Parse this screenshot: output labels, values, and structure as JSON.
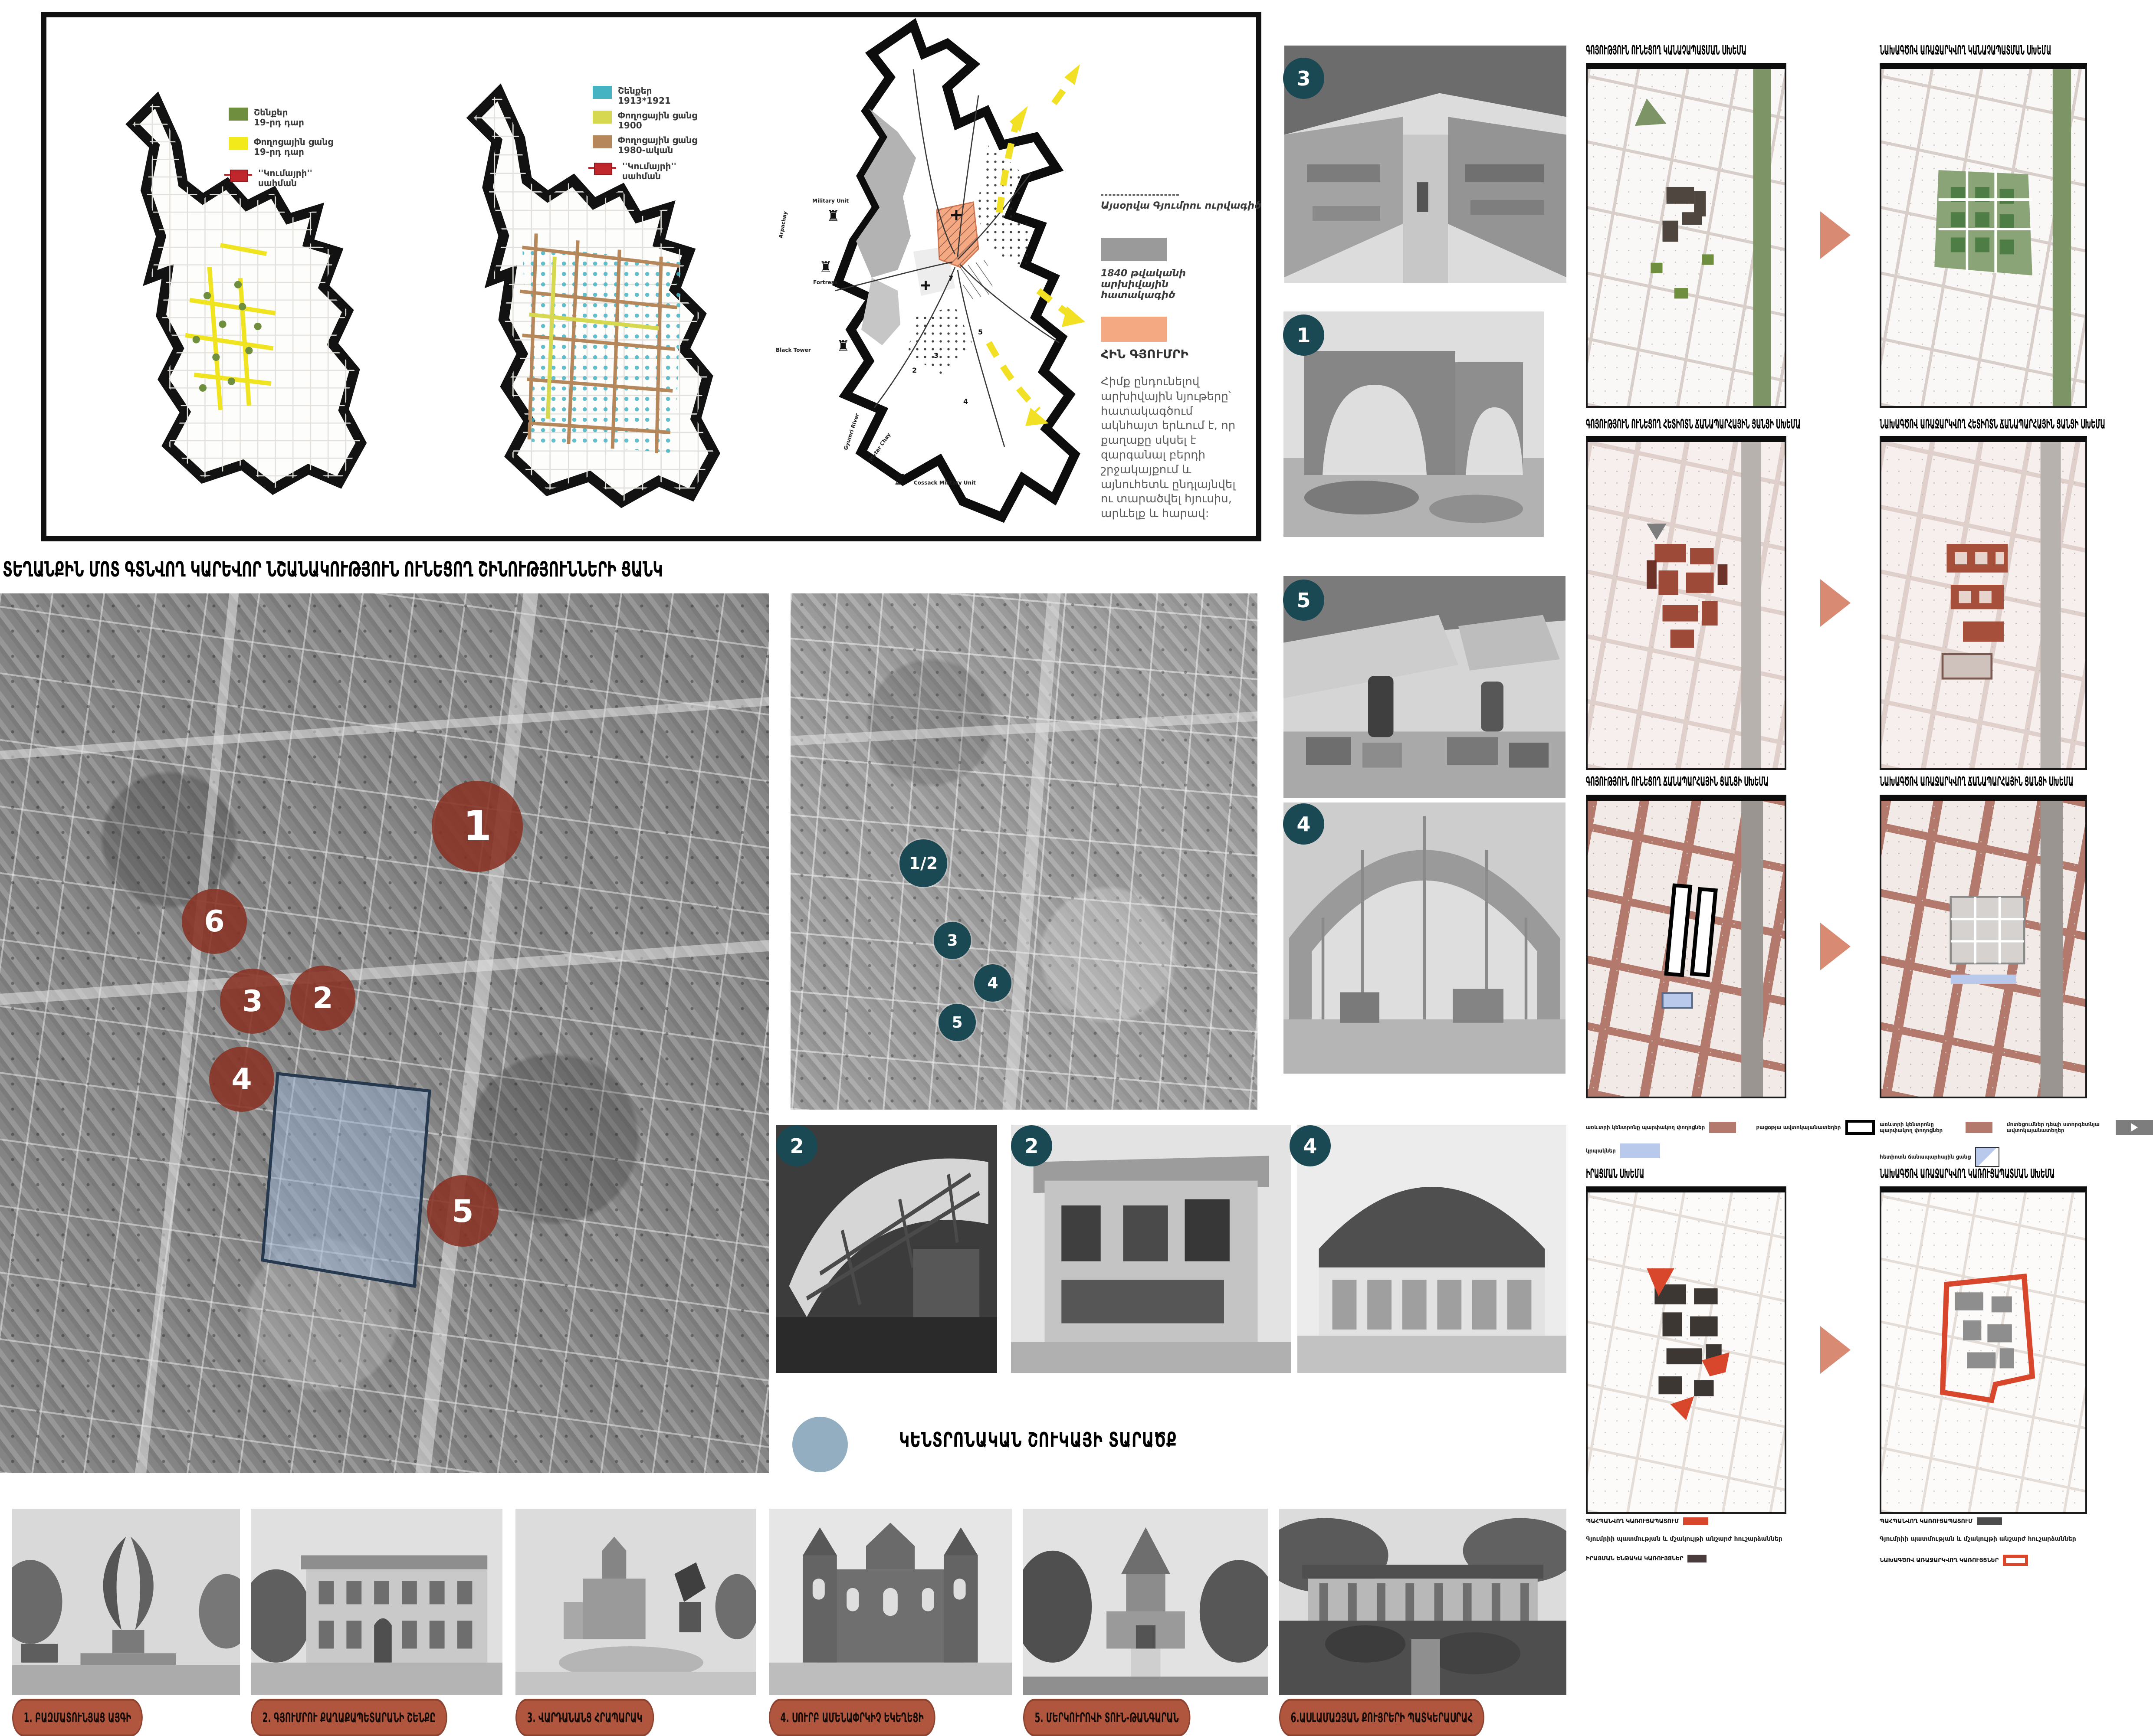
{
  "colors": {
    "accent_terracotta": "#8c392b",
    "accent_teal": "#1a4853",
    "accent_salmon": "#d98a72",
    "accent_red": "#d8472b",
    "legend_green": "#6f8f3f",
    "legend_yellow": "#f2ea1b",
    "legend_teal": "#45b3c2",
    "legend_yellowgreen": "#d6d94f",
    "legend_brown": "#b5875a",
    "legend_boundary_red": "#c0272d",
    "old_gyumri_orange": "#f5a983",
    "archive_gray": "#9a9a9a",
    "kiosk_blue": "#b9c9ec",
    "dark_structure": "#4a3c3c",
    "market_circle_blue": "#92aec0"
  },
  "panel": {
    "legend_a": [
      {
        "l1": "Շենքեր",
        "l2": "19-րդ դար"
      },
      {
        "l1": "Փողոցային ցանց",
        "l2": "19-րդ դար"
      },
      {
        "l1": "''Կումայրի''",
        "l2": "սահման"
      }
    ],
    "legend_b": [
      {
        "l1": "Շենքեր",
        "l2": "1913*1921"
      },
      {
        "l1": "Փողոցային ցանց",
        "l2": "1900"
      },
      {
        "l1": "Փողոցային ցանց",
        "l2": "1980-ական"
      },
      {
        "l1": "''Կումայրի''",
        "l2": "սահման"
      }
    ],
    "map3": {
      "military_unit": "Military Unit",
      "fortress": "Fortress",
      "arpachay": "Arpachay",
      "black_tower": "Black Tower",
      "gyumri_river": "Gyumri River",
      "mxtar_chay": "Mxtar Chay",
      "cossack": "Cossack Military Unit",
      "n2": "2",
      "n3": "3",
      "n4": "4",
      "n5": "5",
      "n7": "7",
      "plus": "+"
    },
    "notes": {
      "outline": "Այսօրվա Գյումրու ուրվագիծ",
      "archive": "1840 թվականի արխիվային հատակագիծ",
      "old_gyumri": "ՀԻՆ ԳՅՈՒՄՐԻ",
      "paragraph": "Հիմք ընդունելով արխիվային նյութերը՝ հատակագծում ակնհայտ երևում է, որ քաղաքը սկսել է զարգանալ բերդի շրջակայքում և այնուհետև ընդլայնվել ու տարածվել հյուսիս, արևելք և հարավ:"
    }
  },
  "main_title": "ՏԵՂԱՆՔԻՆ ՄՈՏ ԳՏՆՎՈՂ ԿԱՐԵՎՈՐ ՆՇԱՆԱԿՈՒԹՅՈՒՆ ՈՒՆԵՑՈՂ ՇԻՆՈՒԹՅՈՒՆՆԵՐԻ ՑԱՆԿ",
  "site_markers": [
    "1",
    "6",
    "3",
    "2",
    "4",
    "5"
  ],
  "detail_markers": [
    "1/2",
    "3",
    "4",
    "5"
  ],
  "photo_badges": [
    "3",
    "1",
    "5",
    "4",
    "2",
    "2",
    "4"
  ],
  "market_area_label": "ԿԵՆՏՐՈՆԱԿԱՆ ՇՈՒԿԱՅԻ ՏԱՐԱԾՔ",
  "schemes": {
    "row1": {
      "left": "ԳՈՅՈՒԹՅՈՒՆ ՈՒՆԵՑՈՂ ԿԱՆԱՉԱՊԱՏՄԱՆ ՍԽԵՄԱ",
      "right": "ՆԱԽԱԳԾՈՎ ԱՌԱՋԱՐԿՎՈՂ ԿԱՆԱՉԱՊԱՏՄԱՆ ՍԽԵՄԱ"
    },
    "row2": {
      "left": "ԳՈՅՈՒԹՅՈՒՆ ՈՒՆԵՑՈՂ ՀԵՏԻՈՏՆ ՃԱՆԱՊԱՐՀԱՅԻՆ ՑԱՆՑԻ ՍԽԵՄԱ",
      "right": "ՆԱԽԱԳԾՈՎ ԱՌԱՋԱՐԿՎՈՂ ՀԵՏԻՈՏՆ ՃԱՆԱՊԱՐՀԱՅԻՆ ՑԱՆՑԻ ՍԽԵՄԱ"
    },
    "row3": {
      "left": "ԳՈՅՈՒԹՅՈՒՆ ՈՒՆԵՑՈՂ ՃԱՆԱՊԱՐՀԱՅԻՆ ՑԱՆՑԻ ՍԽԵՄԱ",
      "right": "ՆԱԽԱԳԾՈՎ ԱՌԱՋԱՐԿՎՈՂ ՃԱՆԱՊԱՐՀԱՅԻՆ ՑԱՆՑԻ ՍԽԵՄԱ"
    },
    "row4": {
      "left": "ԻՐԱՑՄԱՆ ՍԽԵՄԱ",
      "right": "ՆԱԽԱԳԾՈՎ ԱՌԱՋԱՐԿՎՈՂ ԿԱՌՈՒՑԱՊԱՏՄԱՆ ՍԽԵՄԱ"
    },
    "legend3_left": [
      "առևտրի կենտրոնը պարփակող փողոցներ",
      "բացօթյա ավտոկայանատեղեր",
      "կրպակներ"
    ],
    "legend3_right": [
      "առևտրի կենտրոնը պարփակող փողոցներ",
      "մոտեցումներ դեպի ստորգետնյա ավտոկայանատեղեր",
      "հետիոտն ճանապարհային ցանց"
    ],
    "legend4_left": {
      "preserved": "ՊԱՀՊԱՆՎՈՂ ԿԱՌՈՒՑԱՊԱՏՈՒՄ",
      "monuments": "Գյումրիի պատմության և մշակույթի անշարժ հուշարձաններ",
      "demolish": "ԻՐԱՑՄԱՆ ԵՆԹԱԿԱ ԿԱՌՈՒՅՑՆԵՐ"
    },
    "legend4_right": {
      "preserved": "ՊԱՀՊԱՆՎՈՂ ԿԱՌՈՒՑԱՊԱՏՈՒՄ",
      "monuments": "Գյումրիի պատմության և մշակույթի անշարժ հուշարձաններ",
      "proposed": "ՆԱԽԱԳԾՈՎ ԱՌԱՋԱՐԿՎՈՂ ԿԱՌՈՒՅՑՆԵՐ"
    }
  },
  "captions": [
    "1. ԲԱԶՄԱՏՈՒՆՅԱՑ ԱՅԳԻ",
    "2. ԳՅՈՒՄՐՈՒ ՔԱՂԱՔԱՊԵՏԱՐԱՆԻ ՇԵՆՔԸ",
    "3. ՎԱՐԴԱՆԱՆՑ ՀՐԱՊԱՐԱԿ",
    "4. ՍՈՒՐԲ ԱՄԵՆԱՓՐԿԻՉ ԵԿԵՂԵՑԻ",
    "5. ՄԵՐԿՈՒՐՈՎԻ ՏՈՒՆ-ԹԱՆԳԱՐԱՆ",
    "6.ԱՍԼԱՄԱԶՅԱՆ ՔՈՒՅՐԵՐԻ ՊԱՏԿԵՐԱՍՐԱՀ"
  ]
}
